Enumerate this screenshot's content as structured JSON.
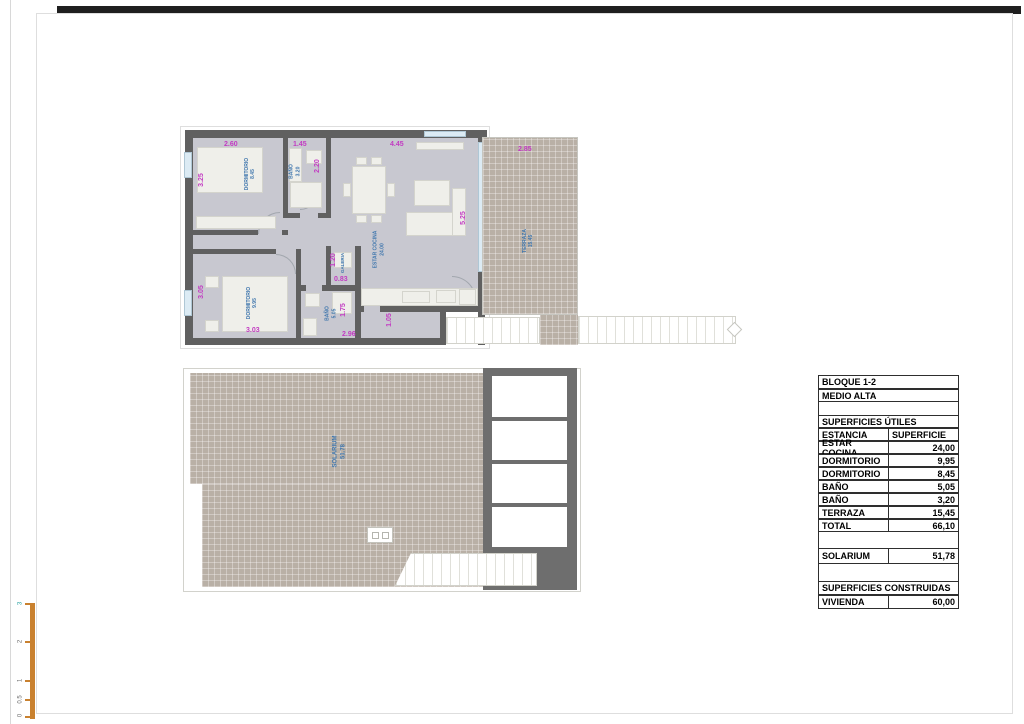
{
  "upper_plan": {
    "rooms": {
      "dorm1": {
        "name": "DORMITORIO",
        "area": "8.45"
      },
      "dorm2": {
        "name": "DORMITORIO",
        "area": "9.95"
      },
      "bano1": {
        "name": "BAÑO",
        "area": "3.20"
      },
      "bano2": {
        "name": "BAÑO",
        "area": "5.05"
      },
      "galeria": {
        "name": "GALERIA"
      },
      "estar": {
        "name": "ESTAR COCINA",
        "area": "24.00"
      },
      "terraza": {
        "name": "TERRAZA",
        "area": "15.45"
      }
    },
    "dims": {
      "dorm1_w": "2.60",
      "dorm1_h": "3.25",
      "bano1_w": "1.45",
      "bano1_h": "2.20",
      "estar_w": "4.45",
      "estar_h": "5.25",
      "terraza_w": "2.85",
      "dorm2_w": "3.03",
      "dorm2_h": "3.05",
      "galeria_w": "0.83",
      "galeria_h": "1.20",
      "bano2_w": "2.96",
      "bano2_h": "1.75",
      "entry_w": "1.05"
    }
  },
  "lower_plan": {
    "room": {
      "name": "SOLARIUM",
      "area": "51.78"
    }
  },
  "area_table": {
    "header1": "BLOQUE 1-2",
    "header2": "MEDIO ALTA",
    "section_utiles": "SUPERFICIES ÚTILES",
    "col_estancia": "ESTANCIA",
    "col_superficie": "SUPERFICIE",
    "rows": [
      {
        "label": "ESTAR COCINA",
        "value": "24,00"
      },
      {
        "label": "DORMITORIO",
        "value": "9,95"
      },
      {
        "label": "DORMITORIO",
        "value": "8,45"
      },
      {
        "label": "BAÑO",
        "value": "5,05"
      },
      {
        "label": "BAÑO",
        "value": "3,20"
      },
      {
        "label": "TERRAZA",
        "value": "15,45"
      },
      {
        "label": "TOTAL",
        "value": "66,10"
      }
    ],
    "solarium_row": {
      "label": "SOLARIUM",
      "value": "51,78"
    },
    "section_construidas": "SUPERFICIES CONSTRUIDAS",
    "vivienda_row": {
      "label": "VIVIENDA",
      "value": "60,00"
    }
  },
  "scale_bar": {
    "labels": [
      "3",
      "2",
      "1",
      "0.5",
      "0"
    ]
  },
  "colors": {
    "wall": "#606060",
    "floor": "#c8c8d0",
    "outdoor_tile": "#b9b0a6",
    "dimension_text": "#c23bc2",
    "room_label_text": "#3f76ad",
    "scale_bar": "#c9812f"
  }
}
